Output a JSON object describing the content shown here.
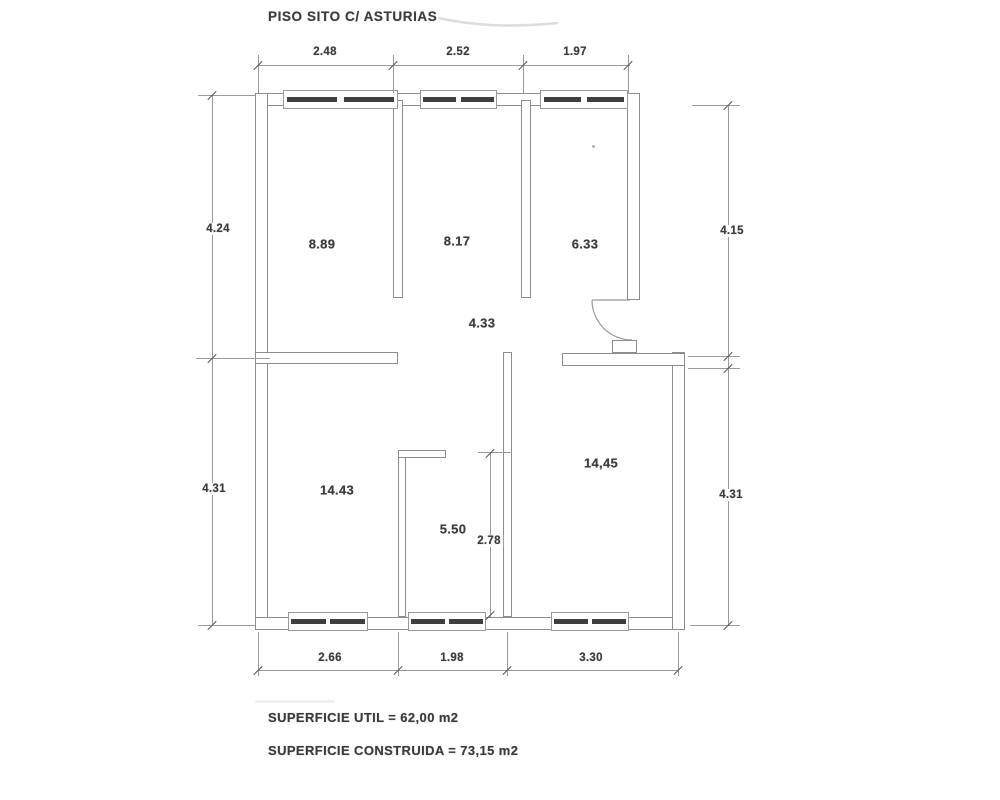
{
  "title": "PISO SITO C/ ASTURIAS",
  "rooms": {
    "r1": "8.89",
    "r2": "8.17",
    "r3": "6.33",
    "hall": "4.33",
    "r4": "14.43",
    "r5": "5.50",
    "r6": "14,45"
  },
  "dims": {
    "top": [
      "2.48",
      "2.52",
      "1.97"
    ],
    "bottom": [
      "2.66",
      "1.98",
      "3.30"
    ],
    "left_upper": "4.24",
    "left_lower": "4.31",
    "right_upper": "4.15",
    "right_lower": "4.31",
    "room5_depth": "2.78"
  },
  "summary": {
    "util": "SUPERFICIE UTIL = 62,00 m2",
    "construida": "SUPERFICIE CONSTRUIDA = 73,15 m2"
  }
}
